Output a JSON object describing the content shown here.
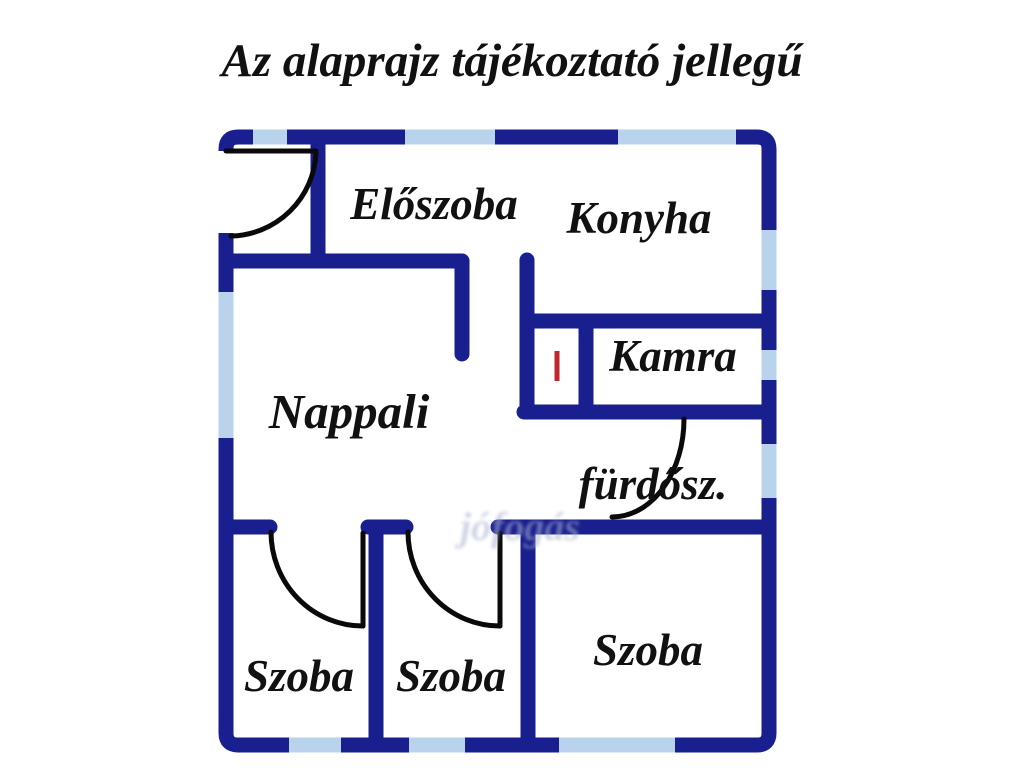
{
  "title": "Az alaprajz tájékoztató jellegű",
  "watermark": "jófogás",
  "colors": {
    "wall": "#1a1f8f",
    "window": "#b9d3ed",
    "door": "#0a0a0a",
    "marker_red": "#c0272d",
    "label_text": "#111111",
    "background": "#ffffff",
    "watermark_color": "#aab4cf"
  },
  "rooms": {
    "eloszoba": {
      "label": "Előszoba"
    },
    "konyha": {
      "label": "Konyha"
    },
    "nappali": {
      "label": "Nappali"
    },
    "kamra": {
      "label": "Kamra"
    },
    "furdoszoba": {
      "label": "fürdősz."
    },
    "szoba_left": {
      "label": "Szoba"
    },
    "szoba_middle": {
      "label": "Szoba"
    },
    "szoba_right": {
      "label": "Szoba"
    }
  }
}
